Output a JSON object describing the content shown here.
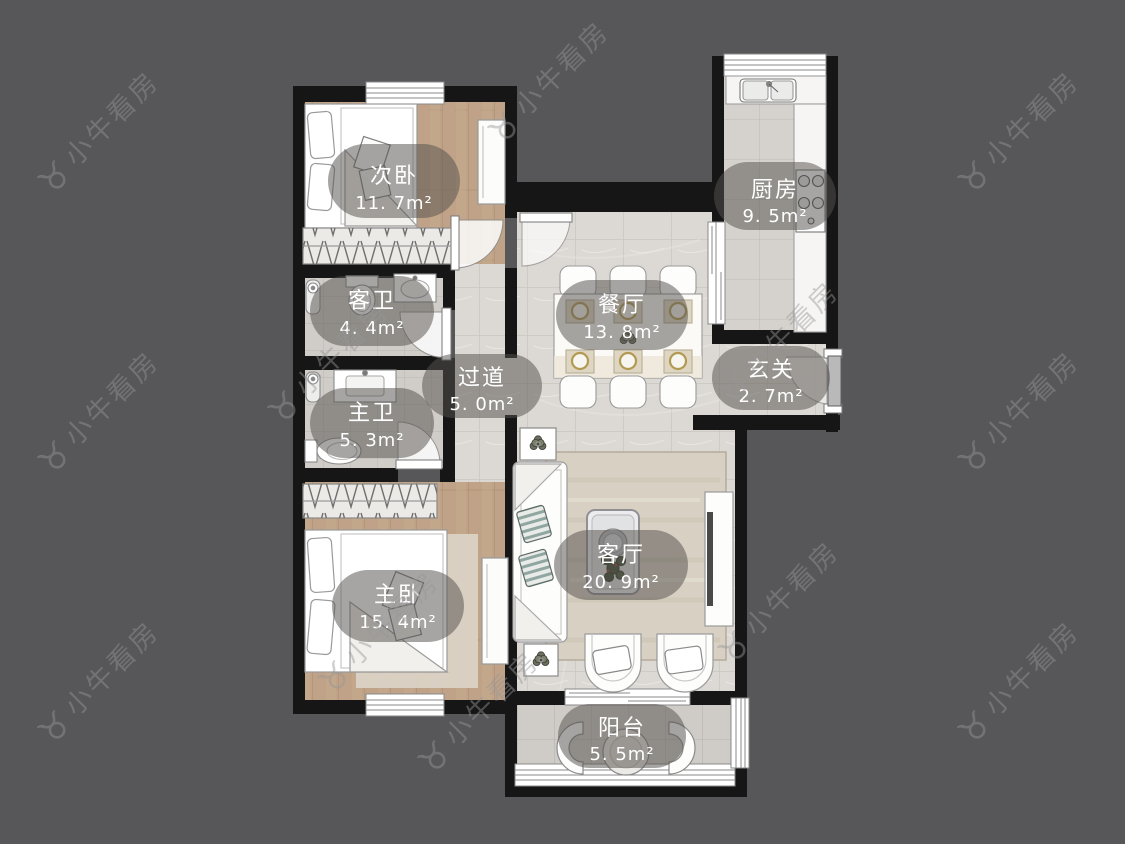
{
  "watermark": {
    "brand": "小牛看房",
    "icon": "bull-logo-icon",
    "icon_glyph": "♉"
  },
  "floorplan": {
    "type": "apartment-floorplan",
    "rooms": [
      {
        "key": "secondary-bedroom",
        "label": "次卧",
        "area": "11. 7m²"
      },
      {
        "key": "kitchen",
        "label": "厨房",
        "area": "9. 5m²"
      },
      {
        "key": "guest-bathroom",
        "label": "客卫",
        "area": "4. 4m²"
      },
      {
        "key": "dining-room",
        "label": "餐厅",
        "area": "13. 8m²"
      },
      {
        "key": "entry",
        "label": "玄关",
        "area": "2. 7m²"
      },
      {
        "key": "hallway",
        "label": "过道",
        "area": "5. 0m²"
      },
      {
        "key": "master-bathroom",
        "label": "主卫",
        "area": "5. 3m²"
      },
      {
        "key": "master-bedroom",
        "label": "主卧",
        "area": "15. 4m²"
      },
      {
        "key": "living-room",
        "label": "客厅",
        "area": "20. 9m²"
      },
      {
        "key": "balcony",
        "label": "阳台",
        "area": "5. 5m²"
      }
    ],
    "colors": {
      "background": "#57575a",
      "wall": "#161616",
      "marble_tile": "#dcd9d4",
      "small_tile": "#d2cfca",
      "wood_floor": "#bfa287",
      "label_pill": "rgba(87,83,78,0.55)",
      "label_text": "#ffffff",
      "furniture_outline": "#8a8a8a",
      "gold_plate_rim": "#b29a52"
    }
  }
}
